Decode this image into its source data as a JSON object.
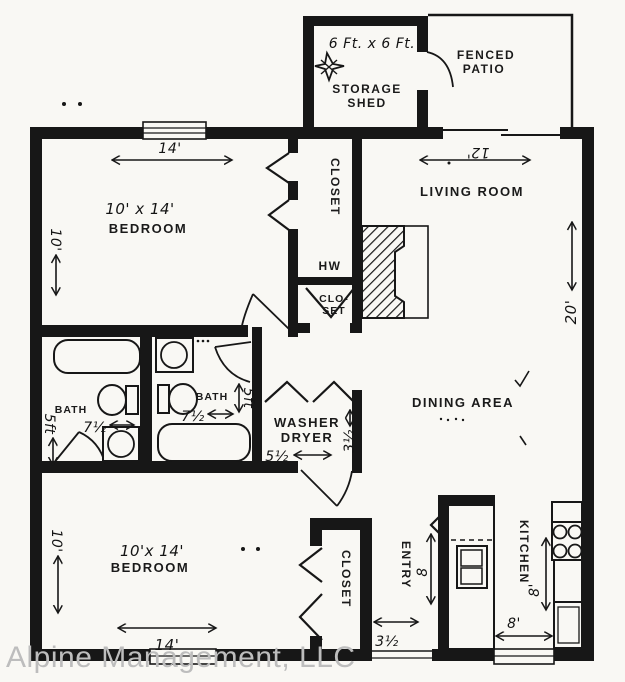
{
  "colors": {
    "ink": "#171717",
    "paper": "#f9f8f4",
    "watermark": "#bdbdbd"
  },
  "watermark": {
    "text": "Alpine Management, LLC"
  },
  "shed": {
    "dimension": "6 Ft. x 6 Ft.",
    "label_line1": "STORAGE",
    "label_line2": "SHED"
  },
  "patio": {
    "label_line1": "FENCED",
    "label_line2": "PATIO"
  },
  "bedroom_top": {
    "size": "10' x 14'",
    "label": "BEDROOM",
    "width_dim": "14'",
    "depth_dim": "10'"
  },
  "living_room": {
    "label": "LIVING ROOM",
    "width_dim": "12'",
    "depth_dim": "20'"
  },
  "closet_hall": {
    "label": "CLOSET"
  },
  "water_heater": {
    "label": "HW"
  },
  "small_closet": {
    "line1": "CLO-",
    "line2": "SET"
  },
  "bath_left": {
    "label": "BATH",
    "width_dim": "7½",
    "depth_dim": "5ft"
  },
  "bath_right": {
    "label": "BATH",
    "width_dim": "7½",
    "depth_dim": "5ft"
  },
  "laundry": {
    "line1": "WASHER",
    "line2": "DRYER",
    "width_dim": "5½",
    "depth_dim": "3½"
  },
  "dining": {
    "label": "DINING AREA"
  },
  "bedroom_bottom": {
    "size": "10'x 14'",
    "label": "BEDROOM",
    "width_dim": "14'",
    "depth_dim": "10'"
  },
  "closet_bottom": {
    "label": "CLOSET"
  },
  "entry": {
    "label": "ENTRY",
    "depth_dim": "8",
    "door_dim": "3½"
  },
  "kitchen": {
    "label": "KITCHEN",
    "depth_dim": "8'",
    "width_dim": "8'"
  }
}
